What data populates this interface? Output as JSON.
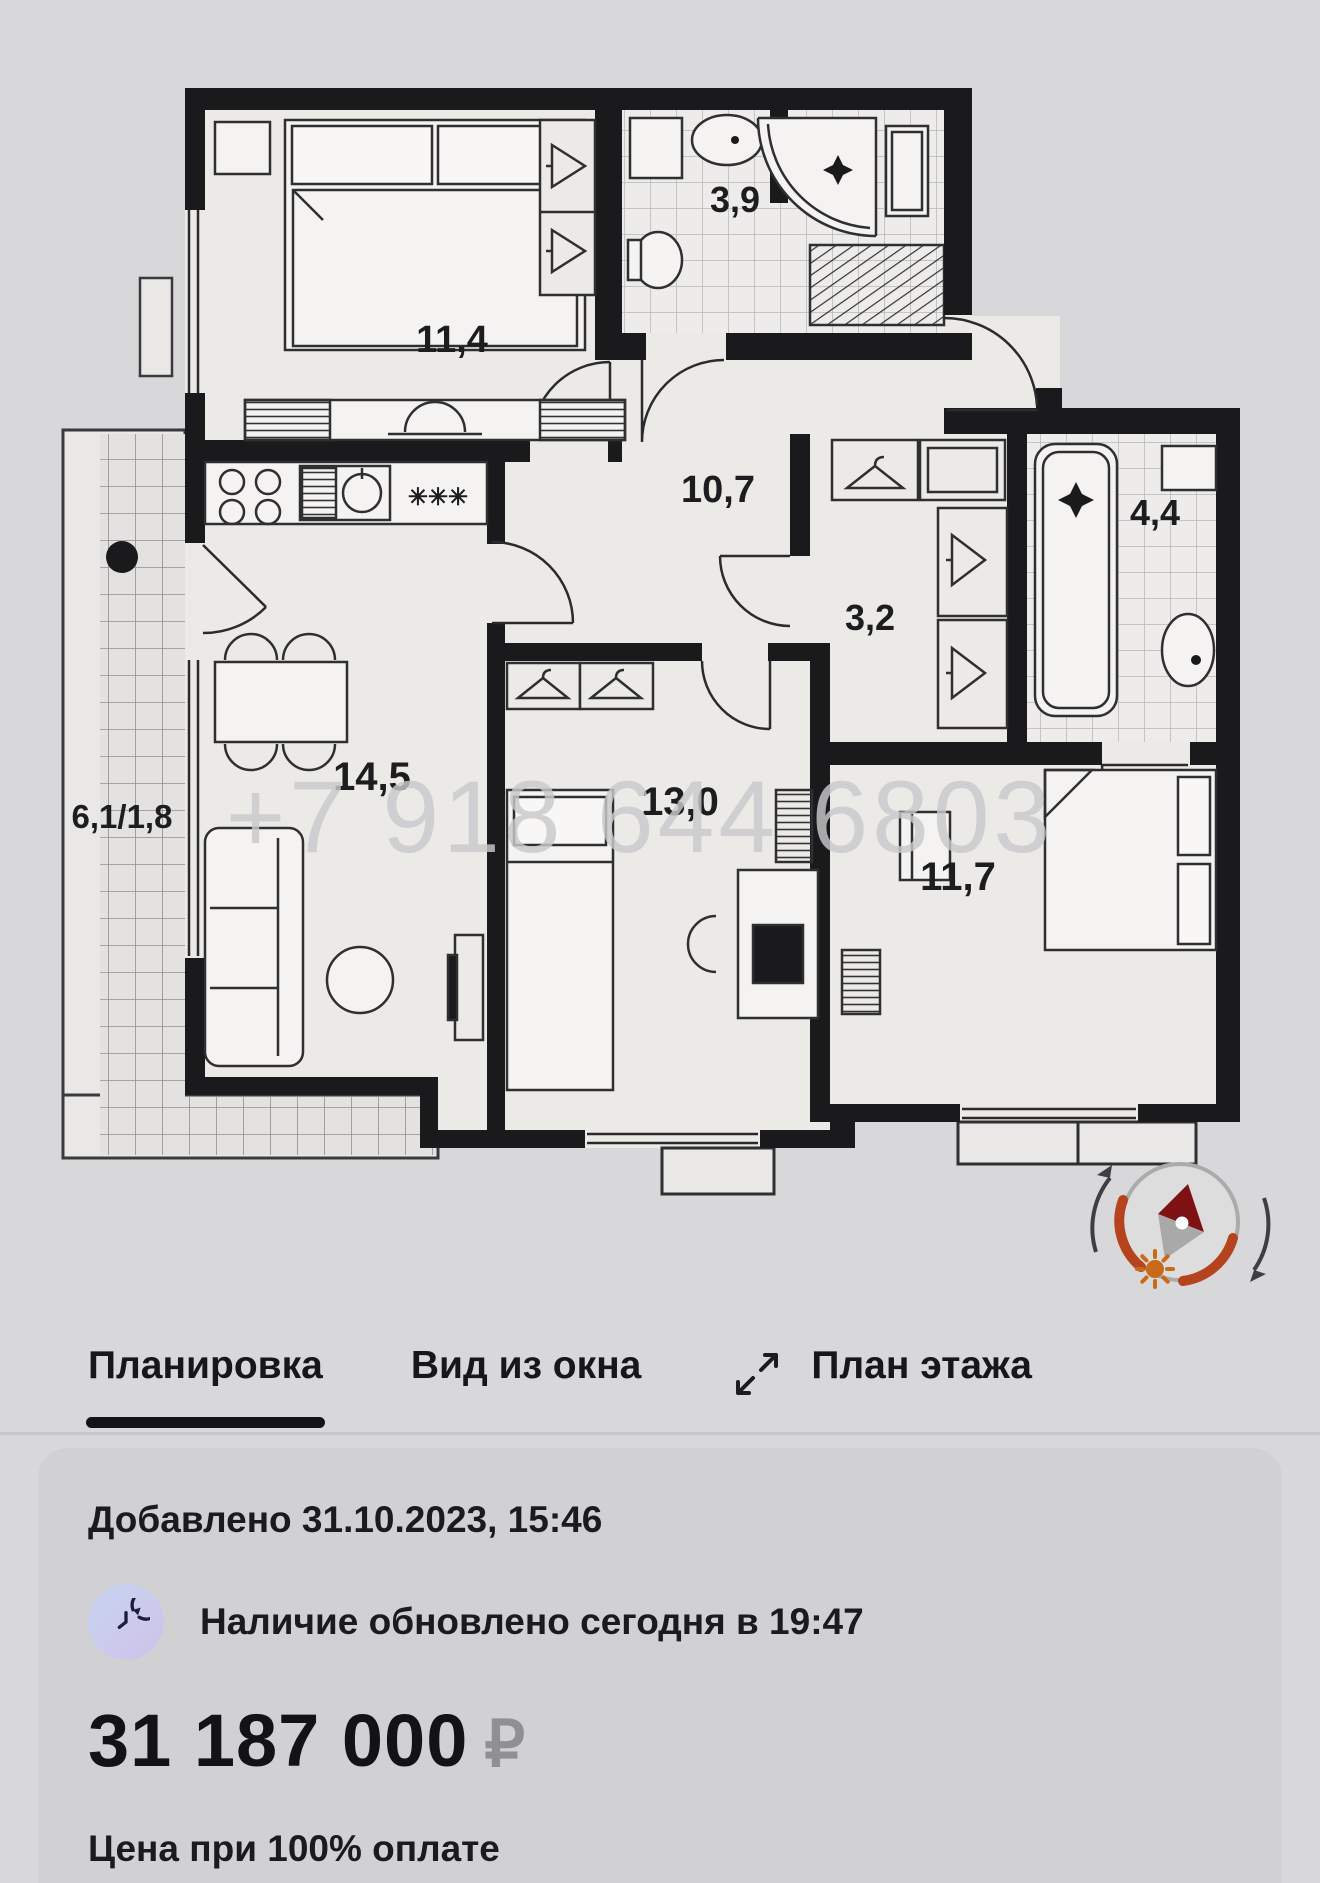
{
  "floor_plan": {
    "watermark": "+7 918 644 6803",
    "kitchen_vent_marker": "✳✳✳",
    "rooms": [
      {
        "name": "bedroom-1",
        "area": "11,4"
      },
      {
        "name": "bathroom-1",
        "area": "3,9"
      },
      {
        "name": "hallway",
        "area": "10,7"
      },
      {
        "name": "hall",
        "area": "3,2"
      },
      {
        "name": "bathroom-2",
        "area": "4,4"
      },
      {
        "name": "kitchen-living",
        "area": "14,5"
      },
      {
        "name": "bedroom-2",
        "area": "13,0"
      },
      {
        "name": "bedroom-3",
        "area": "11,7"
      },
      {
        "name": "balcony",
        "area": "6,1/1,8"
      }
    ]
  },
  "tabs": [
    {
      "label": "Планировка",
      "active": true
    },
    {
      "label": "Вид из окна",
      "active": false
    },
    {
      "label": "План этажа",
      "active": false
    }
  ],
  "listing": {
    "added": "Добавлено 31.10.2023, 15:46",
    "availability": "Наличие обновлено сегодня в 19:47",
    "price": "31 187 000",
    "currency": "₽",
    "price_note": "Цена при 100% оплате"
  },
  "colors": {
    "wall": "#1a1a1c",
    "accent_orange": "#b5431d",
    "needle_red": "#7e1114",
    "text_primary": "#1b1b1d",
    "currency_gray": "#909094"
  }
}
